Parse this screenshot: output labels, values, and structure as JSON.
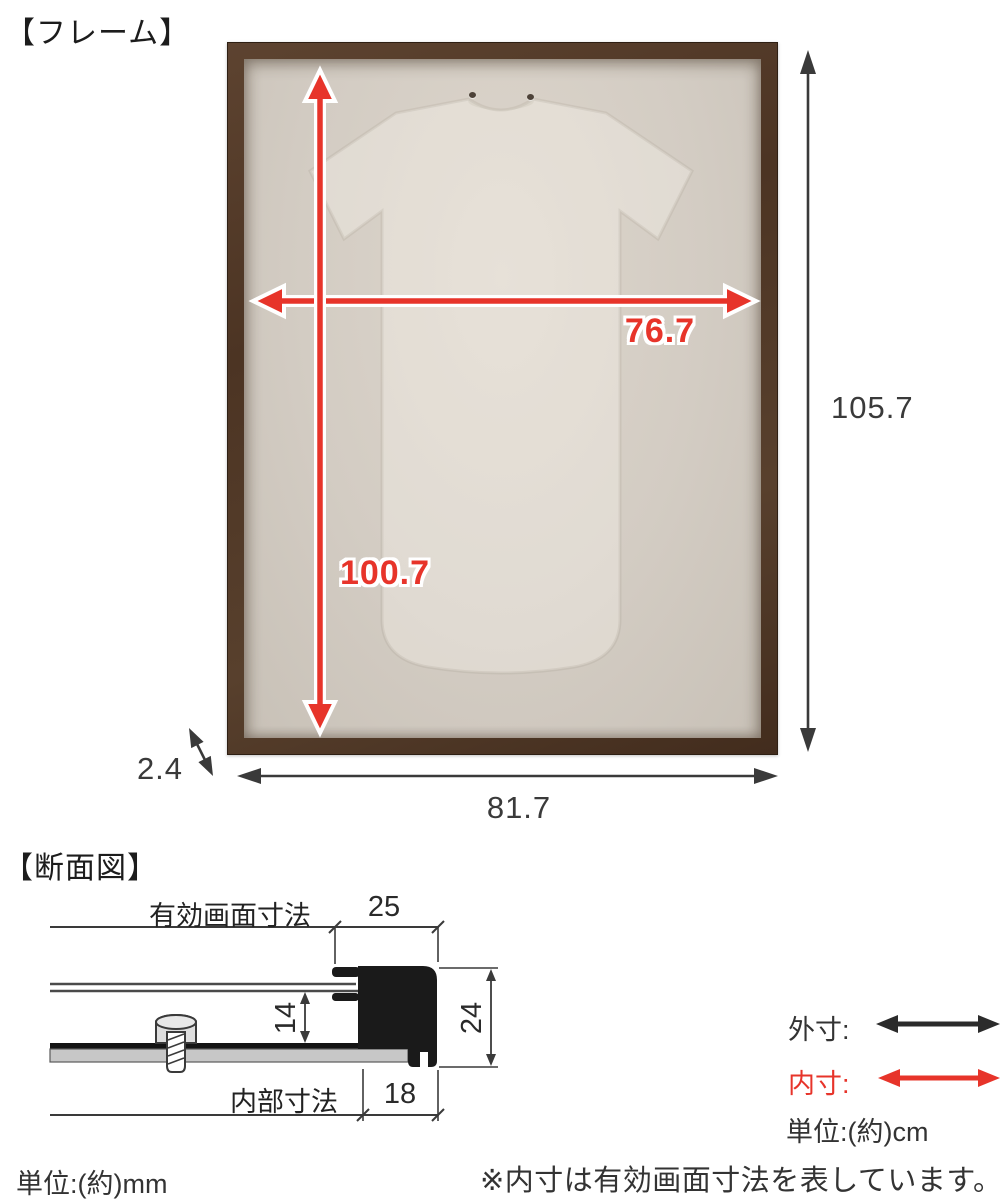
{
  "frame_section": {
    "title": "【フレーム】",
    "inner_width": "76.7",
    "inner_height": "100.7",
    "outer_width": "81.7",
    "outer_height": "105.7",
    "thickness": "2.4"
  },
  "cross_section": {
    "title": "【断面図】",
    "effective_screen_label": "有効画面寸法",
    "internal_label": "内部寸法",
    "front_width": "25",
    "inner_depth": "14",
    "outer_depth": "24",
    "bottom_width": "18",
    "unit_note": "単位:(約)mm"
  },
  "legend": {
    "outer_label": "外寸:",
    "inner_label": "内寸:",
    "unit_note": "単位:(約)cm",
    "footnote": "※内寸は有効画面寸法を表しています。"
  },
  "colors": {
    "dimension_red": "#e7342a",
    "dimension_black": "#3a3a3a",
    "frame_brown": "#54392a",
    "mat_beige": "#d3ccc3"
  }
}
